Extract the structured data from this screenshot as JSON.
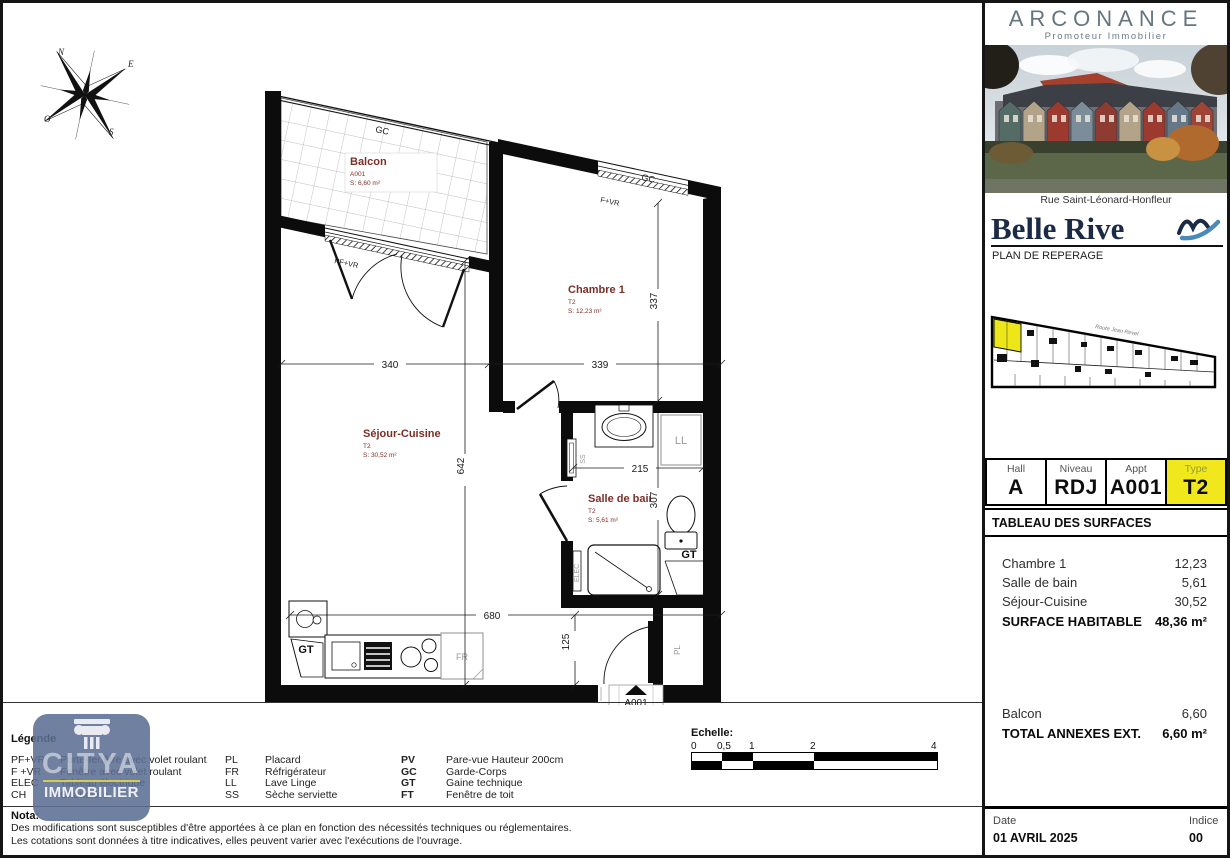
{
  "colors": {
    "yellow": "#f0e71c",
    "maroon": "#7b2f28",
    "navy": "#1c2b45",
    "wave_blue": "#4a8ab8",
    "brand_grey": "#66767f"
  },
  "compass": {
    "n": "N",
    "e": "E",
    "s": "S",
    "o": "O"
  },
  "plan": {
    "rooms": {
      "balcon": {
        "name": "Balcon",
        "code": "A001",
        "area": "S: 6,60 m²"
      },
      "chambre": {
        "name": "Chambre 1",
        "type": "T2",
        "area": "S: 12,23 m²"
      },
      "sejour": {
        "name": "Séjour-Cuisine",
        "type": "T2",
        "area": "S: 30,52 m²"
      },
      "bain": {
        "name": "Salle de bain",
        "type": "T2",
        "area": "S: 5,61 m²"
      }
    },
    "dims": {
      "sejour_width": "340",
      "chambre_width": "339",
      "chambre_depth": "337",
      "sejour_depth": "642",
      "bain_width": "215",
      "bain_depth": "307",
      "total_width": "680",
      "entry_depth": "125"
    },
    "tags": {
      "gc": "GC",
      "pf_vr": "PF+VR",
      "f_vr": "F+VR",
      "ss": "SS",
      "elec": "ELEC",
      "gt": "GT",
      "ll": "LL",
      "fr": "FR",
      "pl": "PL",
      "entry_code": "A001"
    }
  },
  "scalebar": {
    "title": "Echelle:",
    "ticks": [
      "0",
      "0,5",
      "1",
      "2",
      "4"
    ]
  },
  "legend": {
    "title": "Légende",
    "groups": [
      {
        "items": [
          {
            "abbr": "PF+VR",
            "desc": "Porte-fenêtre avec volet roulant"
          },
          {
            "abbr": "F +VR",
            "desc": "Fenêtre avec volet roulant"
          },
          {
            "abbr": "ELEC",
            "desc": "Tableau électrique"
          },
          {
            "abbr": "CH",
            "desc": "Chaudière"
          }
        ]
      },
      {
        "items": [
          {
            "abbr": "PL",
            "desc": "Placard"
          },
          {
            "abbr": "FR",
            "desc": "Réfrigérateur"
          },
          {
            "abbr": "LL",
            "desc": "Lave Linge"
          },
          {
            "abbr": "SS",
            "desc": "Sèche serviette"
          }
        ]
      },
      {
        "items": [
          {
            "abbr": "PV",
            "desc": "Pare-vue Hauteur 200cm"
          },
          {
            "abbr": "GC",
            "desc": "Garde-Corps"
          },
          {
            "abbr": "GT",
            "desc": "Gaine technique"
          },
          {
            "abbr": "FT",
            "desc": "Fenêtre de toit"
          }
        ]
      }
    ]
  },
  "nota": {
    "title": "Nota:",
    "line1": "Des modifications sont susceptibles d'être apportées à ce plan en fonction des nécessités techniques ou réglementaires.",
    "line2": "Les cotations sont données à titre indicatives, elles peuvent varier avec l'exécutions de l'ouvrage."
  },
  "watermark": {
    "name": "CITYA",
    "sub": "IMMOBILIER"
  },
  "sidebar": {
    "brand": "ARCONANCE",
    "tagline": "Promoteur Immobilier",
    "address": "Rue Saint-Léonard-Honfleur",
    "project": "Belle Rive",
    "section": "PLAN DE REPERAGE",
    "street": "Route Jean Revel",
    "unit": {
      "cells": [
        {
          "label": "Hall",
          "value": "A"
        },
        {
          "label": "Niveau",
          "value": "RDJ"
        },
        {
          "label": "Appt",
          "value": "A001"
        },
        {
          "label": "Type",
          "value": "T2"
        }
      ]
    },
    "surfaces": {
      "title": "TABLEAU DES SURFACES",
      "rows": [
        {
          "label": "Chambre 1",
          "value": "12,23"
        },
        {
          "label": "Salle de bain",
          "value": "5,61"
        },
        {
          "label": "Séjour-Cuisine",
          "value": "30,52"
        }
      ],
      "total_label": "SURFACE HABITABLE",
      "total_value": "48,36 m²",
      "annex_rows": [
        {
          "label": "Balcon",
          "value": "6,60"
        }
      ],
      "annex_total_label": "TOTAL ANNEXES EXT.",
      "annex_total_value": "6,60 m²"
    },
    "footer": {
      "date_label": "Date",
      "date_value": "01 AVRIL 2025",
      "indice_label": "Indice",
      "indice_value": "00"
    }
  }
}
